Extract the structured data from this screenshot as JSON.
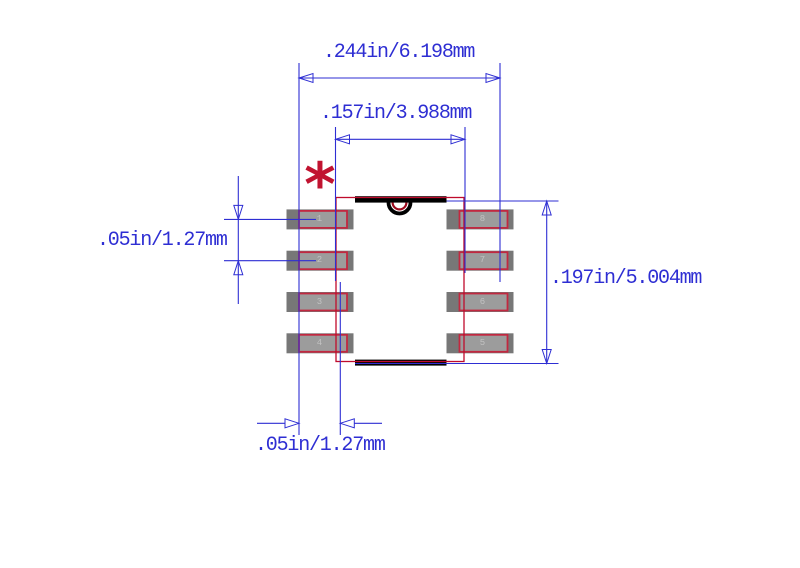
{
  "drawing": {
    "title": "8-pin SOIC package footprint drawing",
    "pin1_marker": "*",
    "dims": {
      "overall_width": ".244in/6.198mm",
      "body_width": ".157in/3.988mm",
      "pin_pitch_left": ".05in/1.27mm",
      "body_height": ".197in/5.004mm",
      "pad_offset_bottom": ".05in/1.27mm"
    },
    "pins": {
      "left": [
        "1",
        "2",
        "3",
        "4"
      ],
      "right": [
        "8",
        "7",
        "6",
        "5"
      ]
    },
    "colors": {
      "dimension_blue": "#2e2ed3",
      "outline_red": "#bf0b2c",
      "pad_rect_red": "#c22840",
      "notch_red": "#9e0a1e",
      "pad_outer_gray": "#777777",
      "pad_inner_gray": "#9c9c9c",
      "pin_number_gray": "#c2c2c2",
      "marker_red": "#c11330",
      "bar_black": "#000000",
      "background": "#ffffff"
    }
  }
}
